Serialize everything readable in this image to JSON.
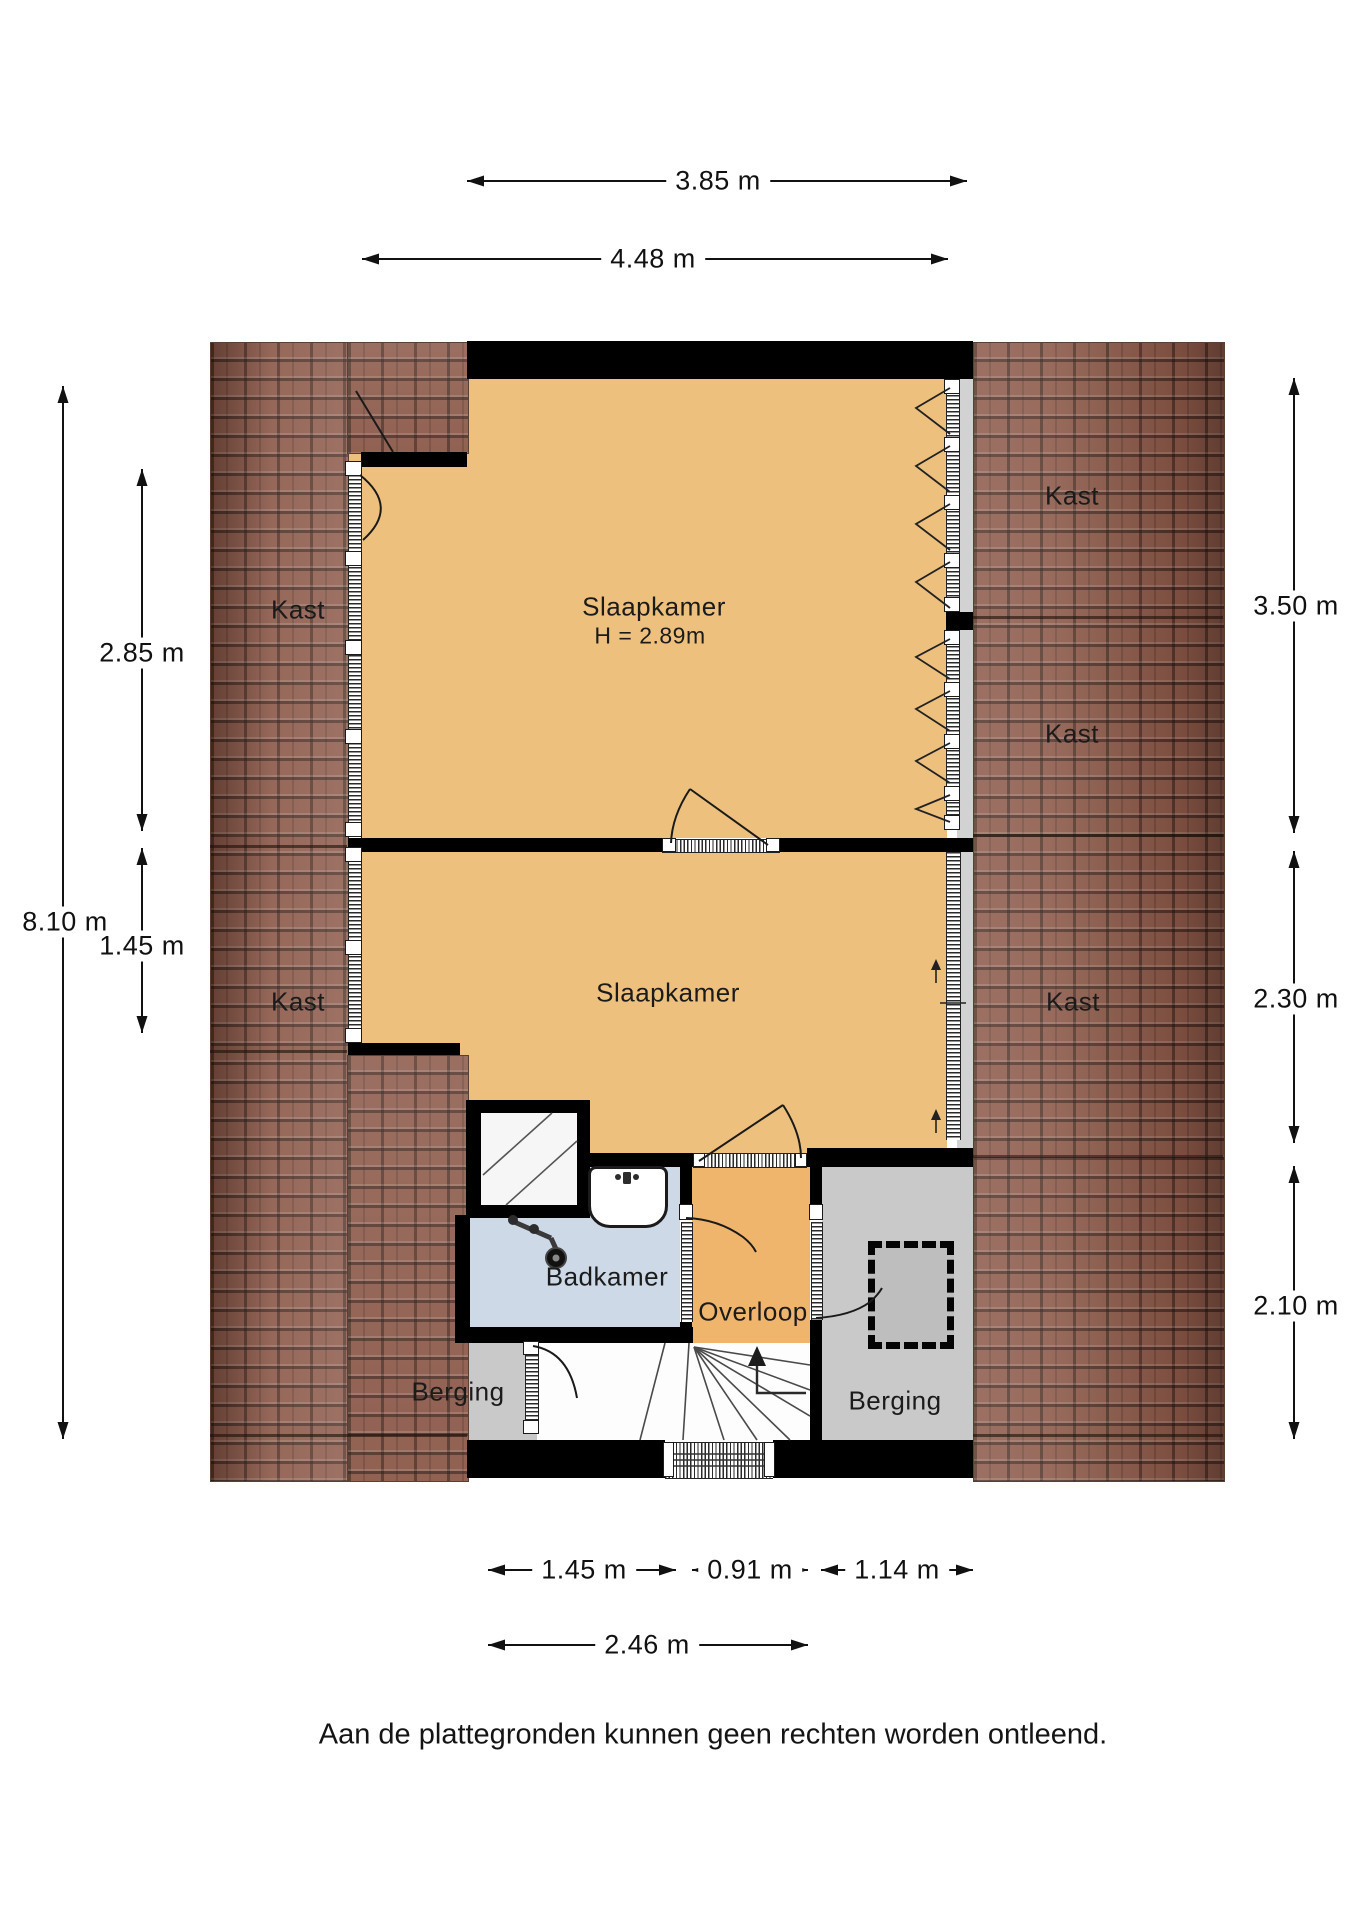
{
  "dimensions": {
    "top": [
      {
        "label": "3.85 m"
      },
      {
        "label": "4.48 m"
      }
    ],
    "left": [
      {
        "label": "2.85 m"
      },
      {
        "label": "8.10 m"
      },
      {
        "label": "1.45 m"
      }
    ],
    "right": [
      {
        "label": "3.50 m"
      },
      {
        "label": "2.30 m"
      },
      {
        "label": "2.10 m"
      }
    ],
    "bottom": [
      {
        "label": "1.45 m"
      },
      {
        "label": "0.91 m"
      },
      {
        "label": "1.14 m"
      },
      {
        "label": "2.46 m"
      }
    ]
  },
  "rooms": {
    "bedroom1": {
      "label": "Slaapkamer",
      "ceiling_height": "H = 2.89m"
    },
    "bedroom2": {
      "label": "Slaapkamer"
    },
    "bathroom": {
      "label": "Badkamer"
    },
    "landing": {
      "label": "Overloop"
    },
    "storage_left": {
      "label": "Berging"
    },
    "storage_right": {
      "label": "Berging"
    },
    "closets": [
      {
        "label": "Kast"
      },
      {
        "label": "Kast"
      },
      {
        "label": "Kast"
      },
      {
        "label": "Kast"
      },
      {
        "label": "Kast"
      }
    ]
  },
  "colors": {
    "room_fill": "#edc07e",
    "landing_fill": "#f0b56c",
    "bathroom_fill": "#cdd9e6",
    "floor_gray": "#c9c9c9",
    "roof_tiles": "#8a5747",
    "wall": "#000000"
  },
  "footer": {
    "disclaimer": "Aan de plattegronden kunnen geen rechten worden ontleend."
  }
}
